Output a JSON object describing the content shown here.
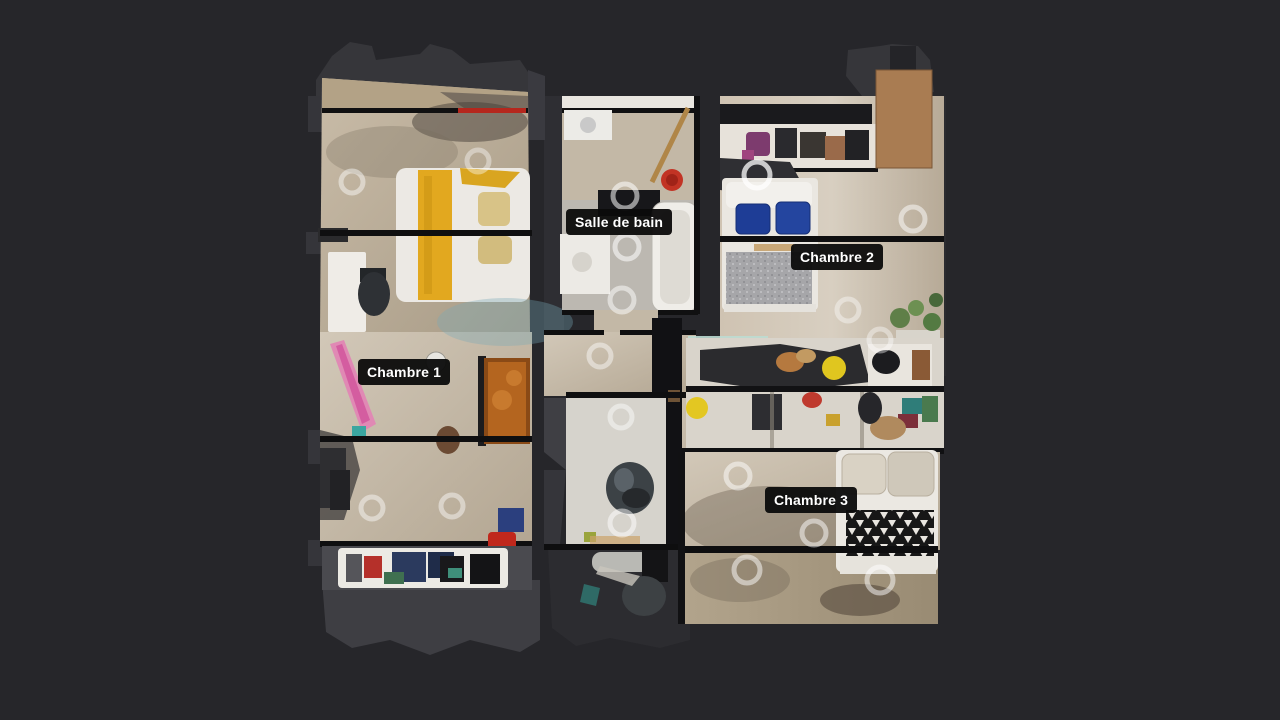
{
  "scene": {
    "type": "3d-dollhouse-floorplan-view",
    "description": "Top-down dollhouse view of a scanned apartment with four labeled rooms",
    "background_color": "#26262a"
  },
  "labels": {
    "bathroom": "Salle de bain",
    "bedroom1": "Chambre 1",
    "bedroom2": "Chambre 2",
    "bedroom3": "Chambre 3"
  },
  "markers": {
    "icon": "sweep-ring-icon",
    "shape": "ring",
    "color": "rgba(255,255,255,0.5)",
    "count": 18
  },
  "palette": {
    "label_bg": "#0b0b0b",
    "label_text": "#ffffff",
    "floor_wood_light": "#d2c8b8",
    "floor_wood_dark": "#a4977f",
    "wall_dark": "#101011",
    "unscanned_gray": "#39393e",
    "accent_red_wall": "#b5271d",
    "bed_stripe_yellow": "#e2a81f",
    "pillow_blue": "#1e3d96",
    "cabinet_orange": "#b4651f",
    "plant_green": "#5f7f48",
    "clutter_pink": "#e089b4"
  }
}
